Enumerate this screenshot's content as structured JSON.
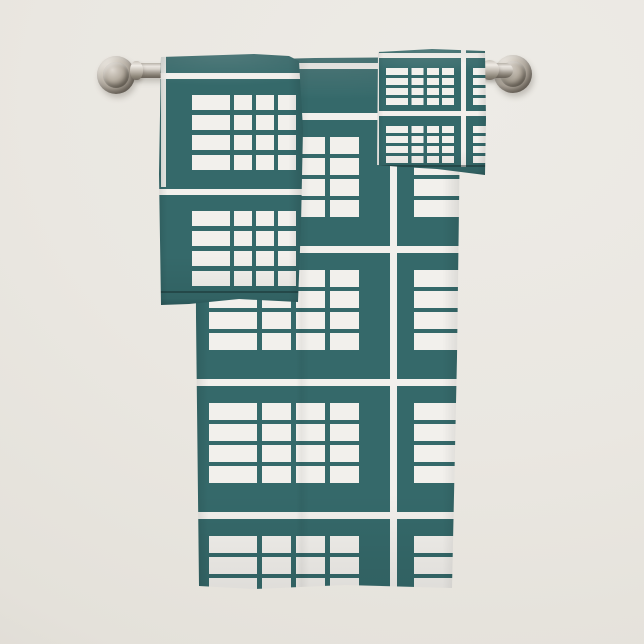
{
  "scene": {
    "type": "product-photo",
    "subject": "3-piece towel set with white windowpane grid pattern on teal, hanging from a towel bar",
    "setting": "plain off-white bathroom wall"
  },
  "colors": {
    "towel_teal": "#35696a",
    "towel_teal_deep": "#2c5a5c",
    "pattern_white": "#f2f0ec",
    "wall": "#eae7e1",
    "wall_light": "#edebe6",
    "wall_shade": "#dedad3",
    "metal_light": "#eee9e3",
    "metal_mid": "#aaa297",
    "metal_dark": "#6a635a"
  },
  "objects": {
    "towel_bar": {
      "label": "brushed nickel towel bar"
    },
    "left_mount": {
      "label": "towel bar wall mount, left"
    },
    "right_mount": {
      "label": "towel bar wall mount, right"
    },
    "bath_towel": {
      "label": "bath towel, teal with white windowpane grid pattern"
    },
    "hand_towel": {
      "label": "hand towel, teal with white windowpane grid pattern"
    },
    "washcloth": {
      "label": "washcloth, teal with white windowpane grid pattern"
    }
  }
}
